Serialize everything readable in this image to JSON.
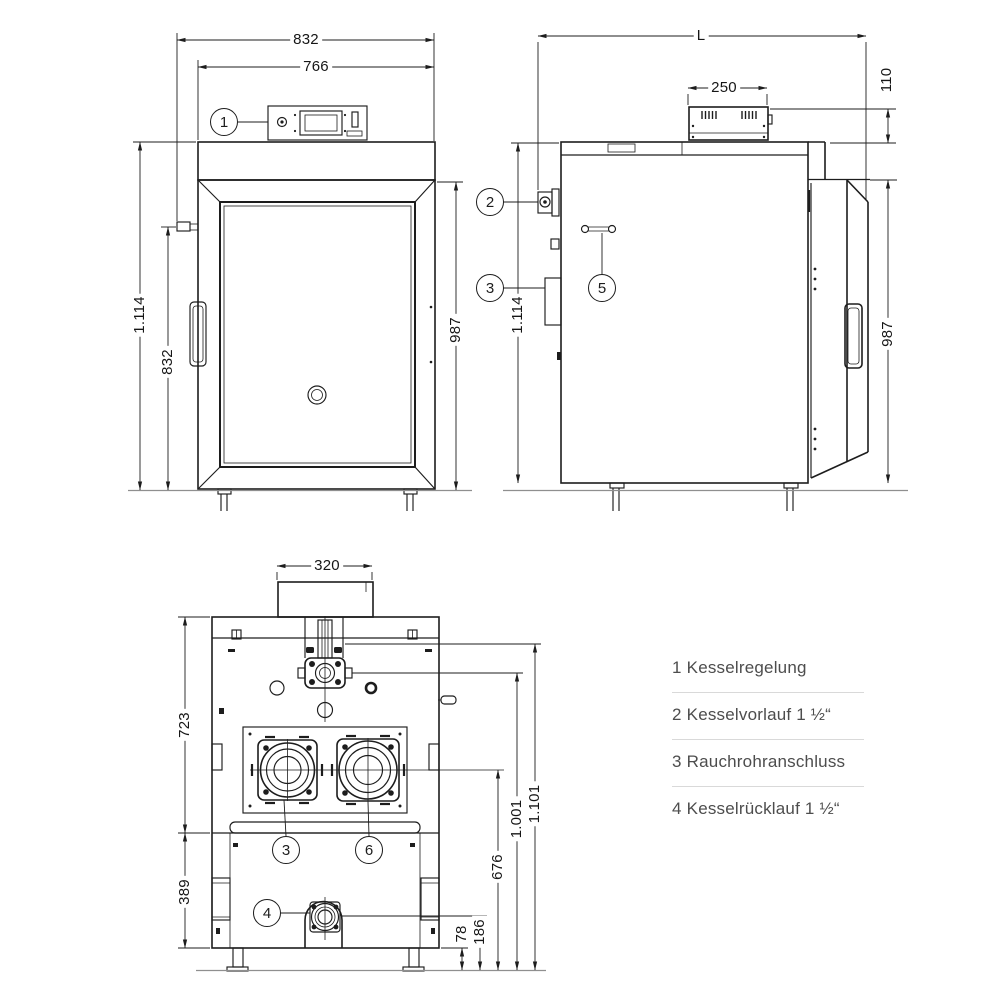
{
  "colors": {
    "background": "#ffffff",
    "line": "#1d1d1d",
    "dim_text": "#161616",
    "legend_text": "#4d4d4d",
    "divider": "#d9d9d9",
    "floor": "#8f8f8f"
  },
  "front_view": {
    "dims": {
      "width_outer": "832",
      "width_inner": "766",
      "height_total": "1.114",
      "height_fitting": "832",
      "height_body": "987"
    },
    "callouts": [
      {
        "num": "1"
      }
    ]
  },
  "side_view": {
    "dims": {
      "length": "L",
      "control_unit_width": "250",
      "control_unit_height": "110",
      "height_total": "1.114",
      "height_body": "987"
    },
    "callouts": [
      {
        "num": "2"
      },
      {
        "num": "3"
      },
      {
        "num": "5"
      }
    ]
  },
  "back_view": {
    "dims": {
      "flue_width": "320",
      "upper_height": "723",
      "lower_height": "389",
      "port_height": "676",
      "valve_height": "1.001",
      "total_height": "1.101",
      "return_offset": "78",
      "return_height": "186"
    },
    "callouts": [
      {
        "num": "3"
      },
      {
        "num": "6"
      },
      {
        "num": "4"
      }
    ]
  },
  "legend": {
    "items": [
      {
        "num": "1",
        "label": "Kesselregelung"
      },
      {
        "num": "2",
        "label": "Kesselvorlauf 1 ½“"
      },
      {
        "num": "3",
        "label": "Rauchrohranschluss"
      },
      {
        "num": "4",
        "label": "Kesselrücklauf 1 ½“"
      }
    ]
  }
}
